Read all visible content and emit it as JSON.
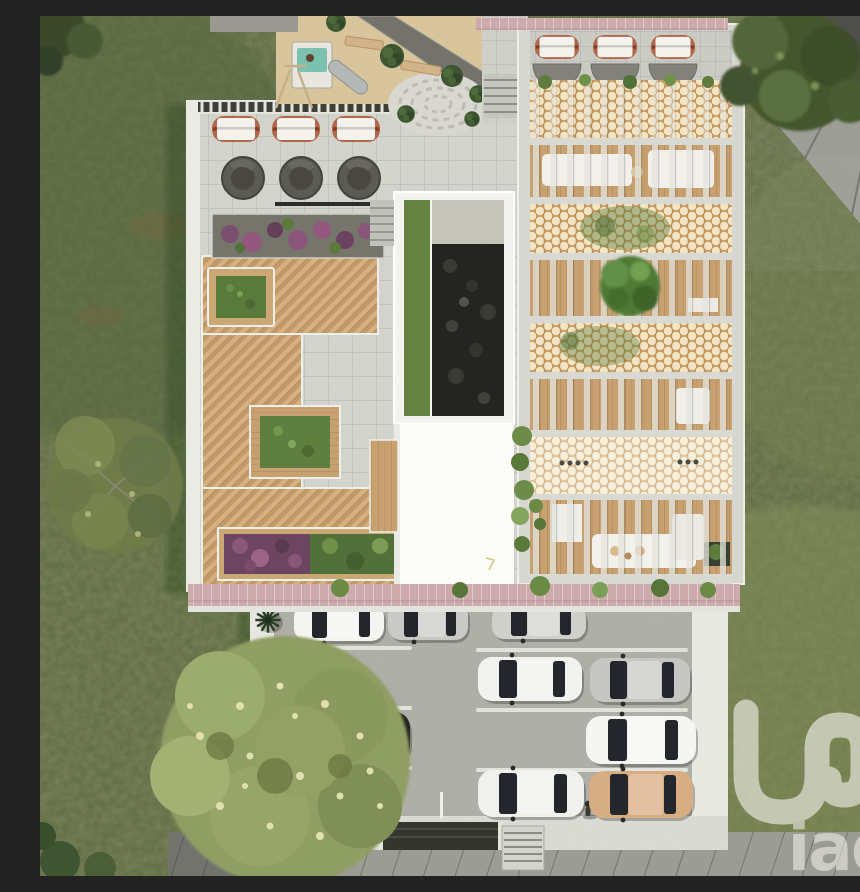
{
  "watermark": {
    "symbol": "iad-monogram-loop",
    "text": "iad",
    "color_hex": "#f4f3ee"
  },
  "scene": {
    "description": "Aerial 3D render of a residential project: rooftop amenity terrace with loungers, spa pods, planters and playground; pergola wing with breeze-block screens and courtyards; surface parking with cars; lawns, trees and street.",
    "palette": {
      "grass": "#67734a",
      "grass_light": "#87905a",
      "roof_tiles": "#d5d5cf",
      "wood_deck": "#cfa878",
      "lattice_tan": "#c49a62",
      "lattice_cream": "#f3e5c3",
      "pink_edging": "#cdabad",
      "asphalt_road": "#4b4b46",
      "sidewalk": "#9c9c95",
      "parking_gravel": "#b8b8b1",
      "white_wall": "#ebebe5",
      "planter_purple": "#8a5679",
      "planter_green": "#5f7f41",
      "spa_pod": "#5b5a53",
      "lounger_copper": "#b2664a"
    },
    "rooftop": {
      "canopy_loungers": 3,
      "spa_pods": 3,
      "playground": {
        "slides": 1,
        "benches": 2,
        "stone_circle": 1
      },
      "planter_beds": [
        "purple flower bed top",
        "grass planter small",
        "grass planter mid",
        "mixed purple-green bed bottom"
      ]
    },
    "pergola_building": {
      "canopy_loungers": 3,
      "screen_bands": 4,
      "pergola_bands": 4,
      "courtyard_trees": 1,
      "white_sofas": 5
    },
    "parking": {
      "stall_lines": 6,
      "palm_shrubs": 5,
      "cars": [
        {
          "row": 1,
          "side": "left",
          "color_name": "white",
          "color_hex": "#f4f4f1"
        },
        {
          "row": 1,
          "side": "left",
          "color_name": "silver",
          "color_hex": "#c9c9c5"
        },
        {
          "row": 1,
          "side": "right",
          "color_name": "silver",
          "color_hex": "#d0d0cb"
        },
        {
          "row": 2,
          "side": "right",
          "color_name": "white",
          "color_hex": "#f2f2ef"
        },
        {
          "row": 2,
          "side": "right",
          "color_name": "silver",
          "color_hex": "#c6c6c2"
        },
        {
          "row": 3,
          "side": "left",
          "color_name": "black",
          "color_hex": "#262624"
        },
        {
          "row": 3,
          "side": "right",
          "color_name": "white",
          "color_hex": "#f5f5f2"
        },
        {
          "row": 4,
          "side": "right",
          "color_name": "white",
          "color_hex": "#f0f0ed"
        },
        {
          "row": 4,
          "side": "right",
          "color_name": "tan",
          "color_hex": "#d7ad83"
        }
      ]
    }
  }
}
